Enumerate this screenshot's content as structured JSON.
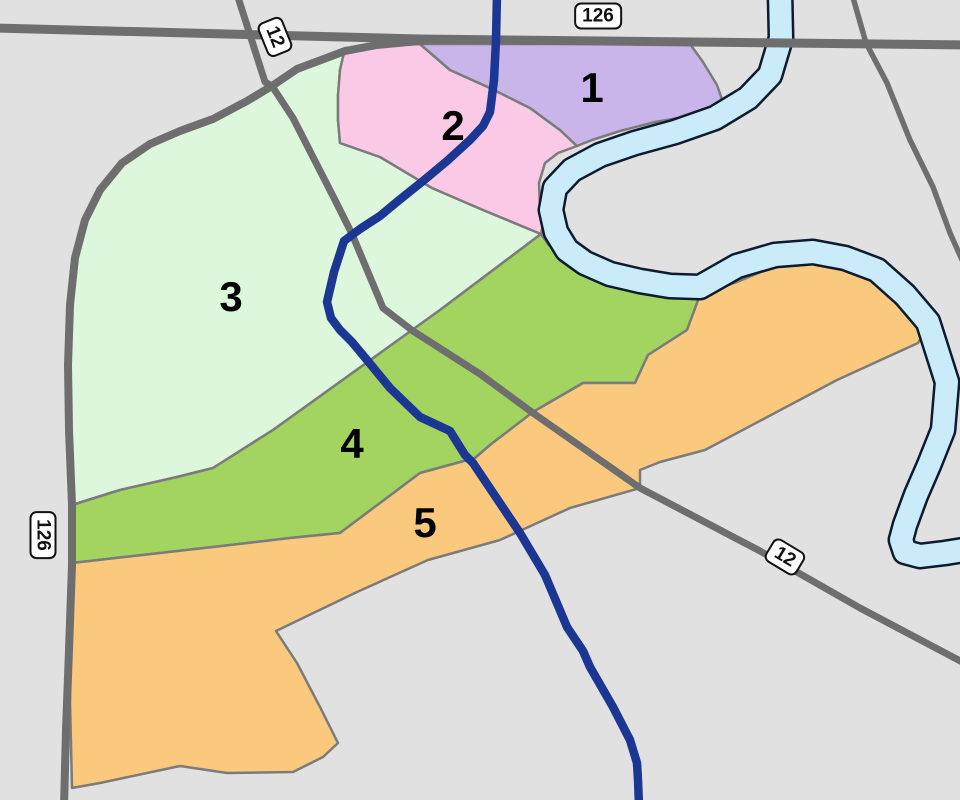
{
  "map": {
    "background_color": "#e1e1e1",
    "boundary_color": "#7b7b7b",
    "road_color": "#6e6e6e",
    "river_fill": "#c9ebfa",
    "river_outline": "#0d1b2e",
    "route_color": "#1c3693",
    "regions": [
      {
        "id": "district-1",
        "label": "1",
        "color": "#c9b5e9"
      },
      {
        "id": "district-2",
        "label": "2",
        "color": "#f9c9e5"
      },
      {
        "id": "district-3",
        "label": "3",
        "color": "#dcf7dc"
      },
      {
        "id": "district-4",
        "label": "4",
        "color": "#a3d45f"
      },
      {
        "id": "district-5",
        "label": "5",
        "color": "#fbc97e"
      }
    ],
    "road_shields": [
      {
        "id": "hwy-126-top",
        "label": "126"
      },
      {
        "id": "hwy-12-topleft",
        "label": "12"
      },
      {
        "id": "hwy-126-left",
        "label": "126"
      },
      {
        "id": "hwy-12-bottomright",
        "label": "12"
      }
    ]
  }
}
